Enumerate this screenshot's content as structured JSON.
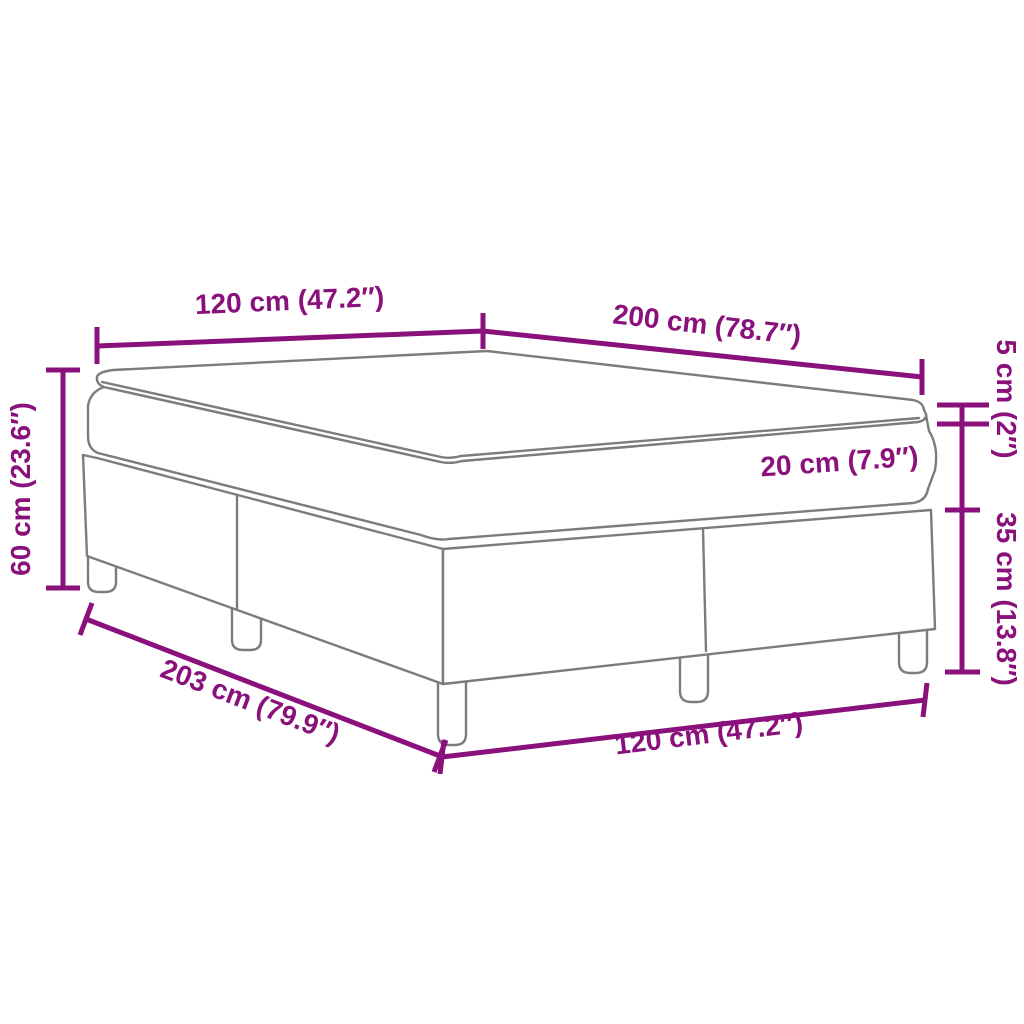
{
  "diagram": {
    "name": "box-spring-bed-with-topper-dimension-diagram",
    "background": "#ffffff",
    "accent_color": "#8a107c",
    "line_color": "#7c7c7c",
    "dimensions": {
      "head_width": {
        "label": "120 cm (47.2″)",
        "cm": 120,
        "inches": 47.2,
        "location": "top-left edge (bed head width)"
      },
      "length": {
        "label": "200 cm (78.7″)",
        "cm": 200,
        "inches": 78.7,
        "location": "top-right edge (bed length)"
      },
      "topper_height": {
        "label": "5 cm (2″)",
        "cm": 5,
        "inches": 2,
        "location": "right side (topper thickness)"
      },
      "mattress_height": {
        "label": "20 cm (7.9″)",
        "cm": 20,
        "inches": 7.9,
        "location": "on mattress side (mattress thickness)"
      },
      "base_height": {
        "label": "35 cm (13.8″)",
        "cm": 35,
        "inches": 13.8,
        "location": "right side (frame with legs height)"
      },
      "total_height": {
        "label": "60 cm (23.6″)",
        "cm": 60,
        "inches": 23.6,
        "location": "left side (total bed height)"
      },
      "total_length": {
        "label": "203 cm (79.9″)",
        "cm": 203,
        "inches": 79.9,
        "location": "bottom-left diagonal (total frame length)"
      },
      "foot_width": {
        "label": "120 cm (47.2″)",
        "cm": 120,
        "inches": 47.2,
        "location": "bottom edge (bed foot width)"
      }
    }
  }
}
